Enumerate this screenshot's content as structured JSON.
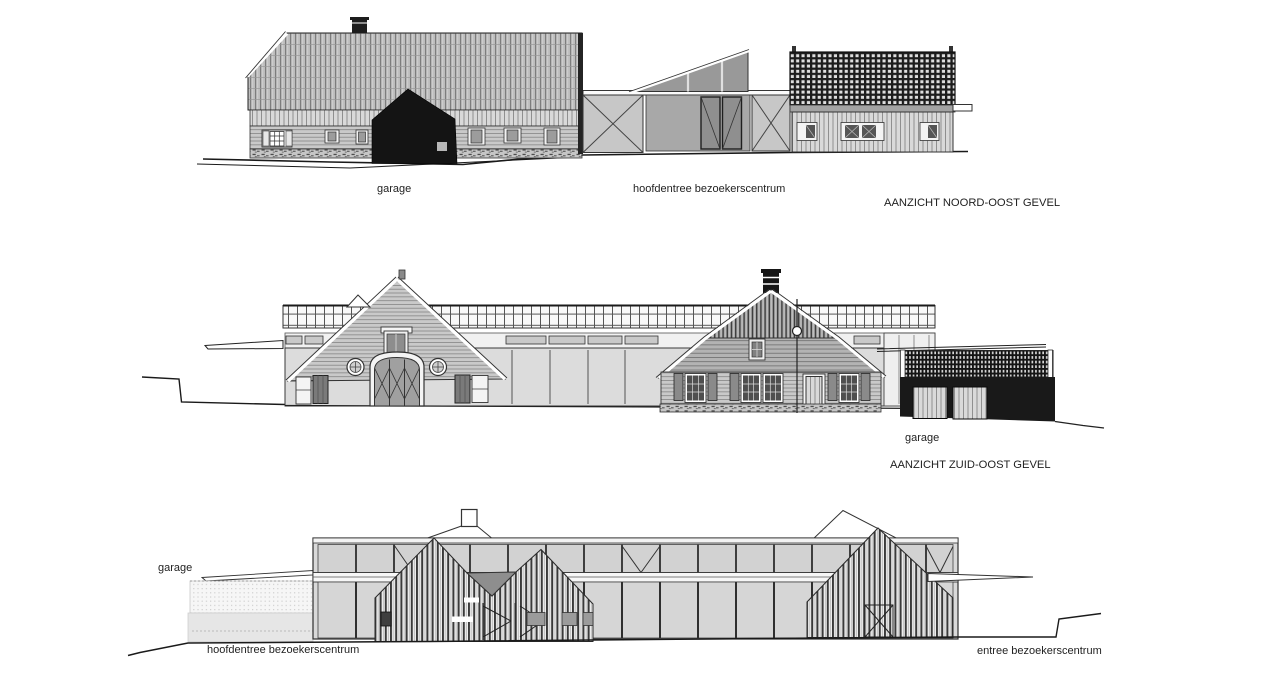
{
  "sheet": {
    "type": "architectural elevation drawing",
    "colors": {
      "paper": "#ffffff",
      "ink": "#1a1a1a",
      "dark_fill": "#161616",
      "mid_gray": "#a8a8a8",
      "light_gray": "#dcdcdc",
      "valley_gray": "#8e8e8e"
    }
  },
  "elevations": {
    "noord_oost": {
      "title": "AANZICHT NOORD-OOST GEVEL",
      "labels": {
        "garage": "garage",
        "hoofdentree": "hoofdentree bezoekerscentrum"
      }
    },
    "zuid_oost": {
      "title": "AANZICHT ZUID-OOST GEVEL",
      "labels": {
        "garage": "garage"
      }
    },
    "onderste": {
      "labels": {
        "garage": "garage",
        "hoofdentree": "hoofdentree bezoekerscentrum",
        "entree": "entree bezoekerscentrum"
      }
    }
  }
}
